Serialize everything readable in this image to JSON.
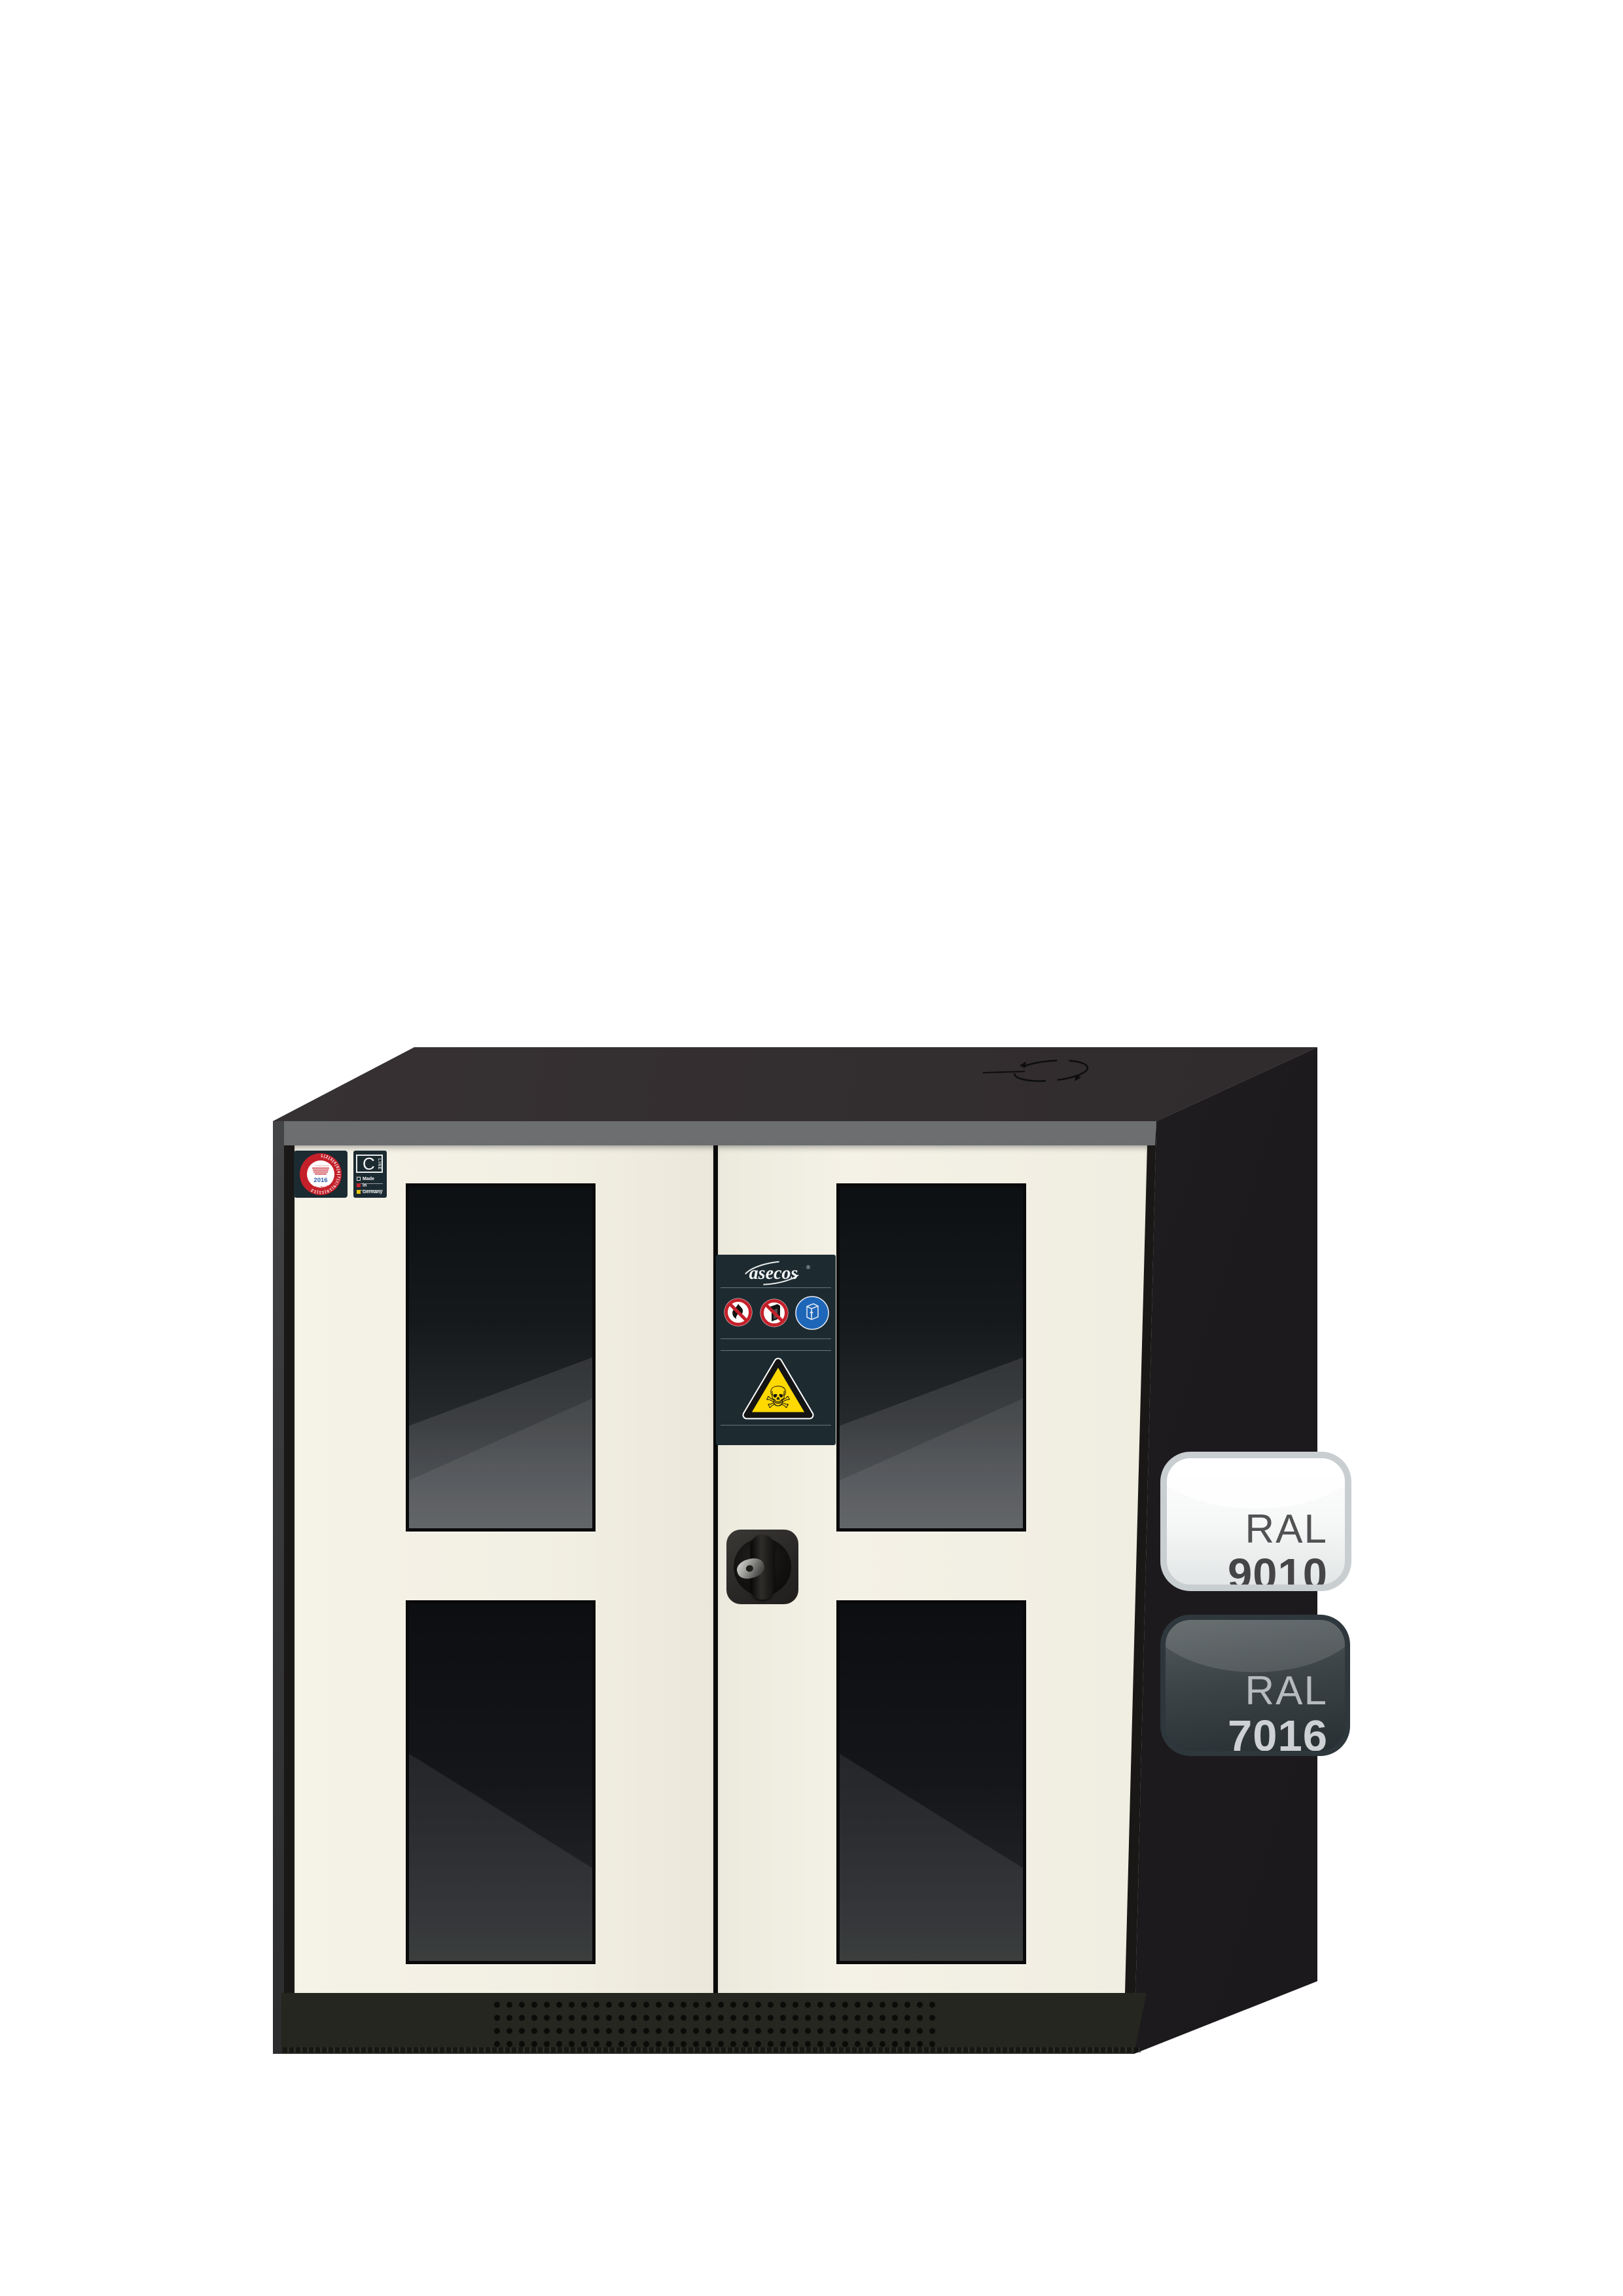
{
  "palette": {
    "door_cream_ral9010": "#F2EFE3",
    "body_dark_ral7016": "#2B2F33",
    "seal_red": "#C4202A",
    "seal_year_blue": "#2A5CAA",
    "mandatory_blue": "#1E66B8",
    "warning_yellow": "#FFD900",
    "plate_background": "#1D2B31"
  },
  "door_labels": {
    "inspection_seal": {
      "icon": "inspection-seal-icon",
      "rim_numbers": "1|2|3|4|5|6|7|8|9|10|11|12",
      "year": "2016",
      "curved_text": "Nächster Prüftermin"
    },
    "series_plate": {
      "letter": "C",
      "vertical_text": "LINE",
      "made_in_lines": [
        "Made",
        "in",
        "Germany"
      ]
    }
  },
  "center_plate": {
    "brand": "asecos",
    "registered_mark": "®",
    "signs": [
      {
        "icon": "no-open-flame-icon"
      },
      {
        "icon": "no-fire-door-icon"
      },
      {
        "icon": "keep-container-closed-icon"
      }
    ],
    "warning": {
      "icon": "toxic-skull-icon",
      "glyph": "☠"
    }
  },
  "hardware": {
    "lock_icon": "cylinder-lock-knob",
    "top_icon": "rotate-arrows-icon"
  },
  "color_badges": [
    {
      "label": "RAL",
      "code": "9010"
    },
    {
      "label": "RAL",
      "code": "7016"
    }
  ]
}
